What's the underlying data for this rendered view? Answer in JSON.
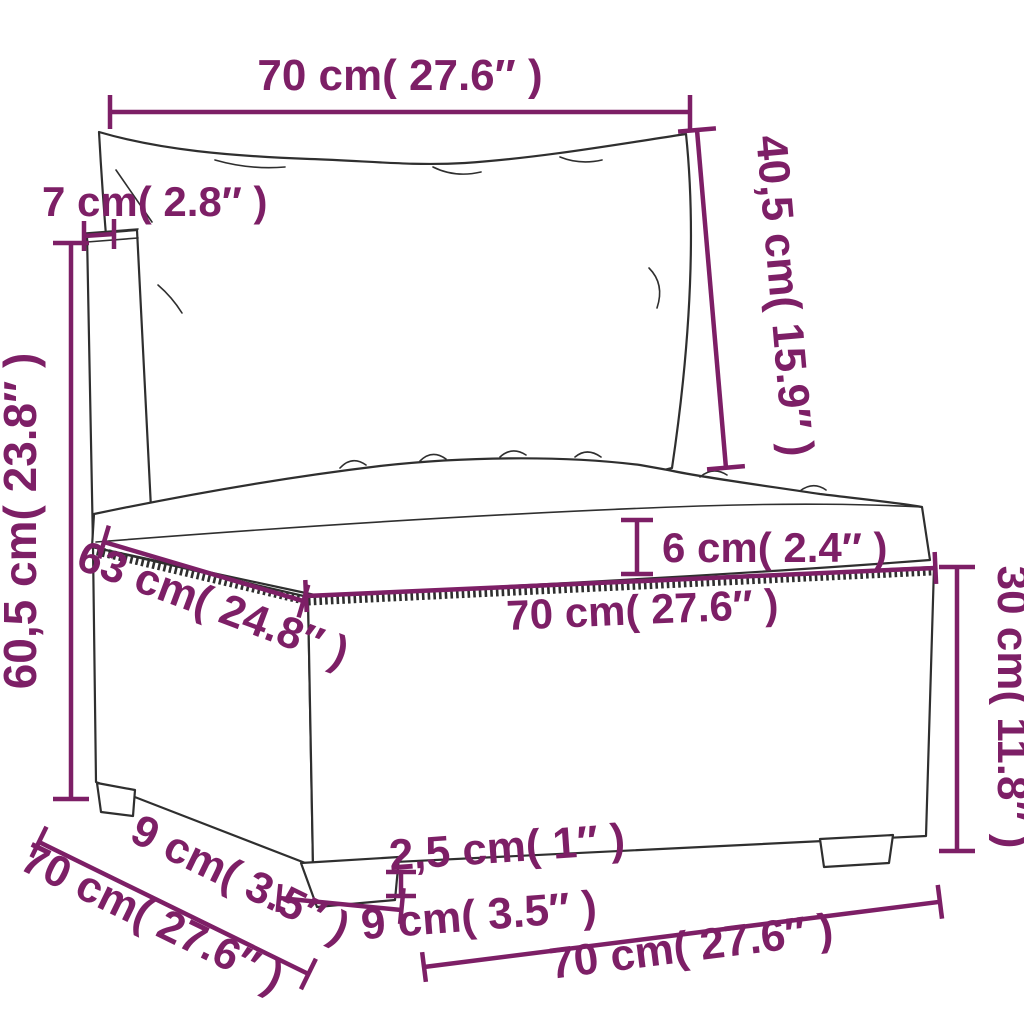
{
  "colors": {
    "dimension_annotation": "#7d1f66",
    "line_art": "#2f2f2f",
    "background": "#ffffff"
  },
  "dims": {
    "top_width": {
      "label": "70 cm( 27.6″ )"
    },
    "frame_7": {
      "label": "7 cm( 2.8″ )"
    },
    "back_40": {
      "label": "40,5 cm( 15.9″ )"
    },
    "height_60": {
      "label": "60,5 cm( 23.8″ )"
    },
    "cushion_6": {
      "label": "6 cm( 2.4″ )"
    },
    "diag_63": {
      "label": "63 cm( 24.8″ )"
    },
    "front_70": {
      "label": "70 cm( 27.6″ )"
    },
    "base_30": {
      "label": "30 cm( 11.8″ )"
    },
    "foot_depth_9": {
      "label": "9 cm( 3.5″ )"
    },
    "depth_70": {
      "label": "70 cm( 27.6″ )"
    },
    "foot_h_25": {
      "label": "2,5 cm( 1″ )"
    },
    "foot_w_9": {
      "label": "9 cm( 3.5″ )"
    },
    "bottom_70": {
      "label": "70 cm( 27.6″ )"
    }
  }
}
